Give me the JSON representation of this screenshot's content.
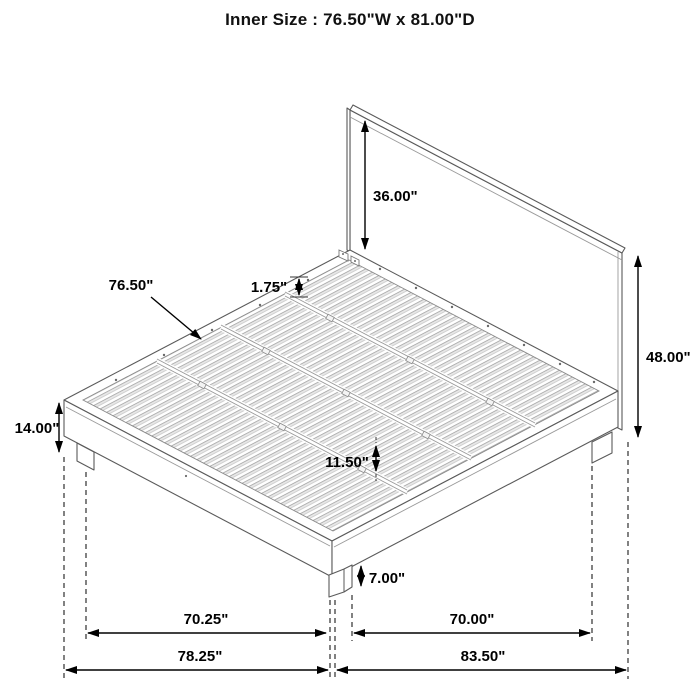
{
  "title": "Inner Size : 76.50\"W x 81.00\"D",
  "dims": {
    "headboard_above_platform": "36.00\"",
    "headboard_total_height": "48.00\"",
    "slat_length": "76.50\"",
    "slat_thickness": "1.75\"",
    "platform_height": "14.00\"",
    "under_bed_clearance": "11.50\"",
    "leg_clearance": "7.00\"",
    "inner_span_left": "70.25\"",
    "outer_span_left": "78.25\"",
    "inner_span_right": "70.00\"",
    "outer_span_right": "83.50\""
  },
  "colors": {
    "ink": "#000000",
    "structure_line": "#5a5a5a",
    "light_line": "#9a9a9a",
    "slat_shade": "#e8e8e8"
  }
}
